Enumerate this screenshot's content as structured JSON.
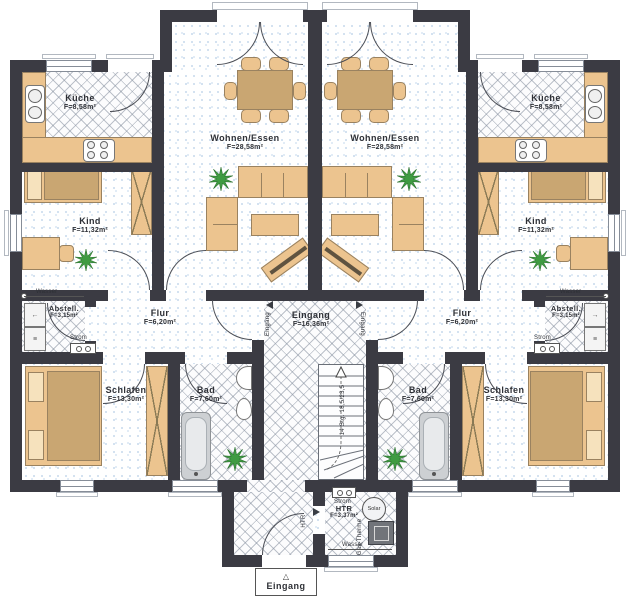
{
  "rooms": {
    "left": {
      "kueche": {
        "name": "Küche",
        "area": "F=8,58m²"
      },
      "kind": {
        "name": "Kind",
        "area": "F=11,32m²"
      },
      "wohnen": {
        "name": "Wohnen/Essen",
        "area": "F=28,58m²"
      },
      "flur": {
        "name": "Flur",
        "area": "F=6,20m²"
      },
      "abstell": {
        "name": "Abstell.",
        "area": "F=3,15m²"
      },
      "schlafen": {
        "name": "Schlafen",
        "area": "F=13,30m²"
      },
      "bad": {
        "name": "Bad",
        "area": "F=7,60m²"
      }
    },
    "right": {
      "kueche": {
        "name": "Küche",
        "area": "F=8,58m²"
      },
      "kind": {
        "name": "Kind",
        "area": "F=11,32m²"
      },
      "wohnen": {
        "name": "Wohnen/Essen",
        "area": "F=28,58m²"
      },
      "flur": {
        "name": "Flur",
        "area": "F=6,20m²"
      },
      "abstell": {
        "name": "Abstell.",
        "area": "F=3,15m²"
      },
      "schlafen": {
        "name": "Schlafen",
        "area": "F=13,30m²"
      },
      "bad": {
        "name": "Bad",
        "area": "F=7,60m²"
      }
    },
    "center": {
      "eingang": {
        "name": "Eingang",
        "area": "F=16,36m²"
      },
      "htr": {
        "name": "HTR",
        "area": "F=3,37m²"
      }
    }
  },
  "labels": {
    "entrance": "Eingang",
    "entrance_arrow": "△",
    "entrance_door_left": "Eingang",
    "entrance_door_right": "Eingang",
    "htr_door": "HTR",
    "stairs": "14 Stg. 18,5/23,5",
    "wasser_left": "Wasser",
    "wasser_right": "Wasser",
    "wasser_htr": "Wasser",
    "strom_left": "Strom",
    "strom_right": "Strom",
    "strom_htr": "Strom",
    "solar": "Solar",
    "gas_therme": "Gas-Therme"
  },
  "colors": {
    "wall": "#3b3b43",
    "furniture": "#ecc48f",
    "plant": "#3f9b42",
    "tile_line": "#87919f"
  }
}
